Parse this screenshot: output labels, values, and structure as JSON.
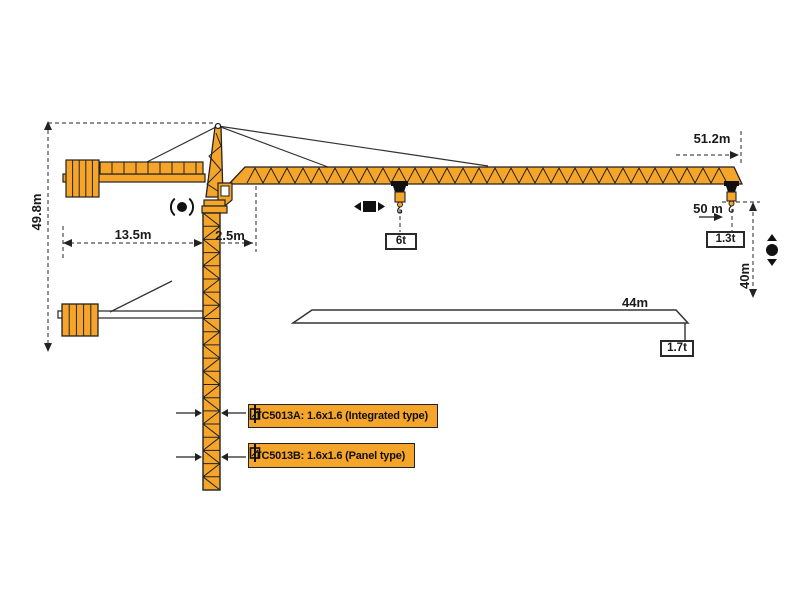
{
  "diagram": {
    "dims": {
      "total_height": "49.8m",
      "counter_jib_radius": "13.5m",
      "rear_offset": "2.5m",
      "max_radius": "51.2m",
      "jib_length": "50 m",
      "hook_height": "40m",
      "alt_jib_length": "44m"
    },
    "loads": {
      "mid_load": "6t",
      "tip_load": "1.3t",
      "alt_tip_load": "1.7t"
    },
    "variants": [
      {
        "label": "TC5013A: 1.6x1.6 (Integrated type)"
      },
      {
        "label": "TC5013B: 1.6x1.6 (Panel type)"
      }
    ],
    "colors": {
      "crane_orange": "#F6A52B",
      "outline": "#222222",
      "dimension_gray": "#4d4d4d"
    }
  }
}
